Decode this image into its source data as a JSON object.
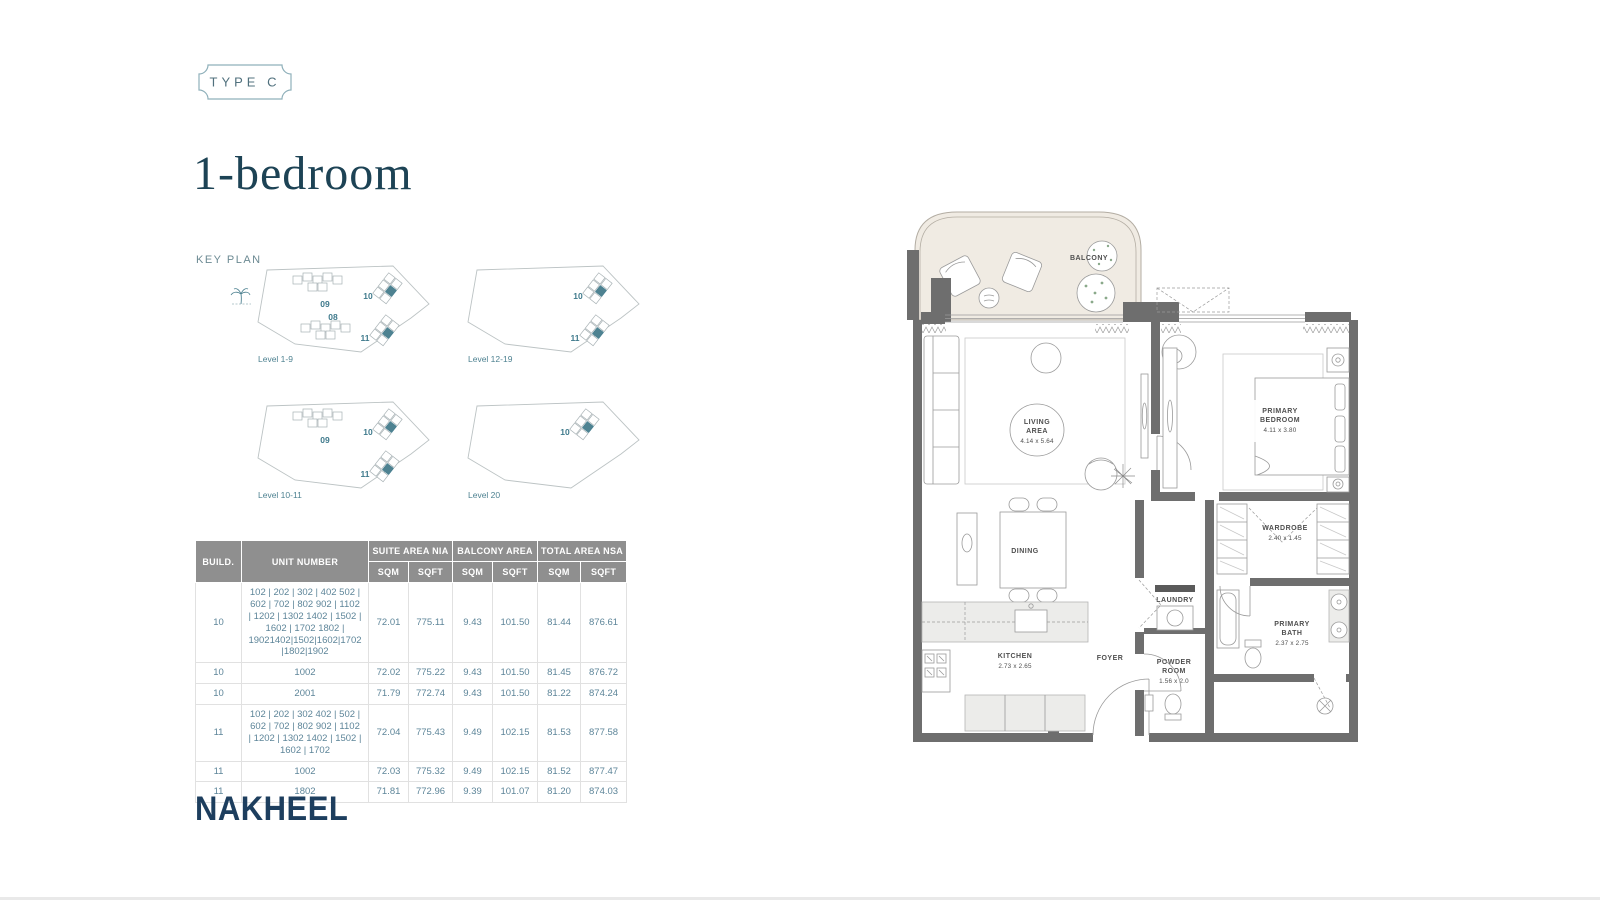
{
  "badge": {
    "label": "TYPE C"
  },
  "title": "1-bedroom",
  "keyplan": {
    "title": "KEY PLAN",
    "plans": [
      {
        "label": "Level 1-9",
        "buildings": [
          "09",
          "10",
          "08",
          "11"
        ]
      },
      {
        "label": "Level 12-19",
        "buildings": [
          "10",
          "11"
        ]
      },
      {
        "label": "Level 10-11",
        "buildings": [
          "09",
          "10",
          "11"
        ]
      },
      {
        "label": "Level 20",
        "buildings": [
          "10"
        ]
      }
    ]
  },
  "table": {
    "col_build": "BUILD.",
    "col_unit": "UNIT NUMBER",
    "group_suite": "SUITE AREA NIA",
    "group_balcony": "BALCONY AREA",
    "group_total": "TOTAL AREA NSA",
    "sqm": "SQM",
    "sqft": "SQFT",
    "rows": [
      {
        "build": "10",
        "units": "102 | 202 | 302 | 402 502 | 602 | 702 | 802 902 | 1102 | 1202 | 1302 1402 | 1502 | 1602 | 1702 1802 | 19021402|1502|1602|1702|1802|1902",
        "suite_sqm": "72.01",
        "suite_sqft": "775.11",
        "bal_sqm": "9.43",
        "bal_sqft": "101.50",
        "tot_sqm": "81.44",
        "tot_sqft": "876.61"
      },
      {
        "build": "10",
        "units": "1002",
        "suite_sqm": "72.02",
        "suite_sqft": "775.22",
        "bal_sqm": "9.43",
        "bal_sqft": "101.50",
        "tot_sqm": "81.45",
        "tot_sqft": "876.72"
      },
      {
        "build": "10",
        "units": "2001",
        "suite_sqm": "71.79",
        "suite_sqft": "772.74",
        "bal_sqm": "9.43",
        "bal_sqft": "101.50",
        "tot_sqm": "81.22",
        "tot_sqft": "874.24"
      },
      {
        "build": "11",
        "units": "102 | 202 | 302 402 | 502 | 602 | 702 | 802 902 | 1102 | 1202 | 1302 1402 | 1502 | 1602 | 1702",
        "suite_sqm": "72.04",
        "suite_sqft": "775.43",
        "bal_sqm": "9.49",
        "bal_sqft": "102.15",
        "tot_sqm": "81.53",
        "tot_sqft": "877.58"
      },
      {
        "build": "11",
        "units": "1002",
        "suite_sqm": "72.03",
        "suite_sqft": "775.32",
        "bal_sqm": "9.49",
        "bal_sqft": "102.15",
        "tot_sqm": "81.52",
        "tot_sqft": "877.47"
      },
      {
        "build": "11",
        "units": "1802",
        "suite_sqm": "71.81",
        "suite_sqft": "772.96",
        "bal_sqm": "9.39",
        "bal_sqft": "101.07",
        "tot_sqm": "81.20",
        "tot_sqft": "874.03"
      }
    ]
  },
  "logo": {
    "text": "NAKHEEL"
  },
  "floorplan": {
    "balcony": "BALCONY",
    "living_l1": "LIVING",
    "living_l2": "AREA",
    "living_dims": "4.14 x 5.64",
    "bedroom_l1": "PRIMARY",
    "bedroom_l2": "BEDROOM",
    "bedroom_dims": "4.11 x 3.80",
    "dining": "DINING",
    "wardrobe_l1": "WARDROBE",
    "wardrobe_dims": "2.40 x 1.45",
    "laundry": "LAUNDRY",
    "kitchen_l1": "KITCHEN",
    "kitchen_dims": "2.73 x 2.65",
    "foyer": "FOYER",
    "powder_l1": "POWDER",
    "powder_l2": "ROOM",
    "powder_dims": "1.56 x 2.0",
    "bath_l1": "PRIMARY",
    "bath_l2": "BATH",
    "bath_dims": "2.37 x 2.75"
  },
  "colors": {
    "accent_teal": "#4e8291",
    "title_navy": "#1d4355",
    "logo_navy": "#1d3e5e",
    "table_header_gray": "#8f8f8f",
    "wall_gray": "#6e6e6e",
    "balcony_beige": "#f0ebe3"
  }
}
